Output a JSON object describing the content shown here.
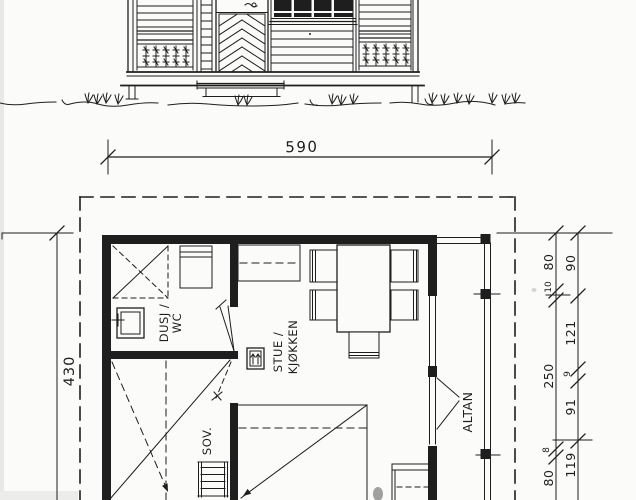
{
  "plan": {
    "width_dim": "590",
    "height_dim": "430",
    "rooms": {
      "bathroom": {
        "line1": "DUSJ /",
        "line2": "WC"
      },
      "living_kitchen": {
        "line1": "STUE /",
        "line2": "KJØKKEN"
      },
      "bedroom": {
        "label": "SOV."
      },
      "balcony": {
        "label": "ALTAN"
      }
    },
    "right_dim_chains": {
      "inner": [
        "80",
        "10",
        "250",
        "8",
        "80"
      ],
      "outer": [
        "90",
        "121",
        "9",
        "91",
        "119"
      ]
    }
  },
  "colors": {
    "ink": "#1e1e1e",
    "paper": "#fbfbf9"
  }
}
